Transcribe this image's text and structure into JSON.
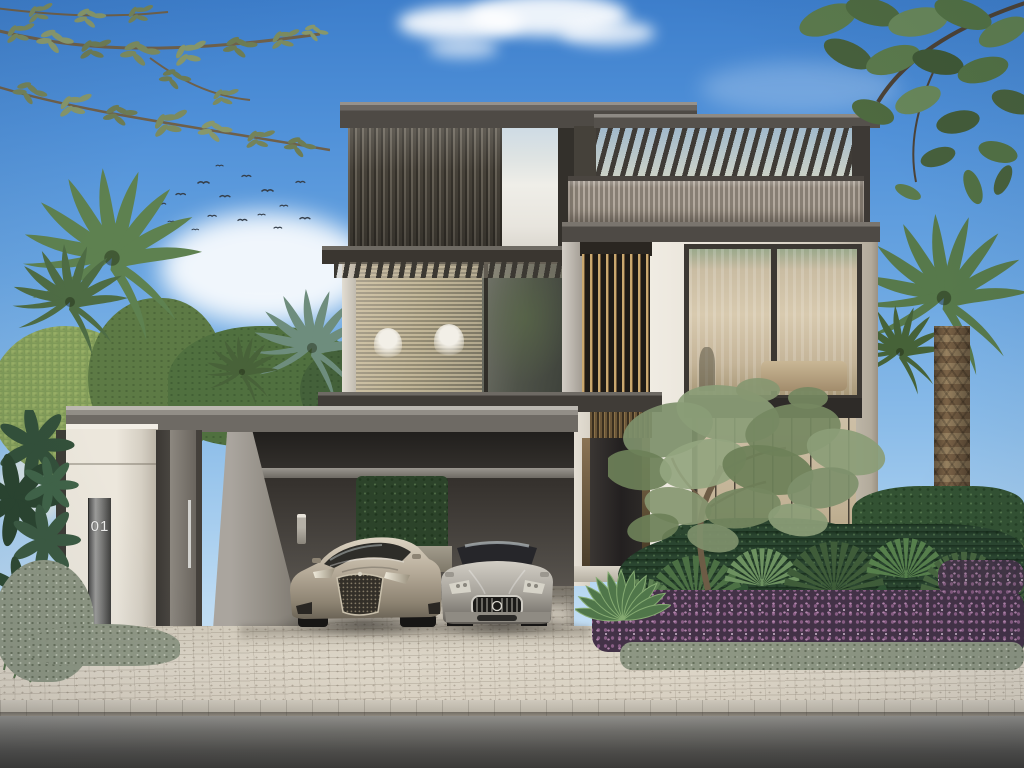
{
  "house": {
    "number_plate": {
      "value": "01",
      "material": "brushed-steel"
    }
  },
  "palette": {
    "sky_top": "#3d7ecb",
    "sky_horizon": "#d8eaf8",
    "facade_light_stone": "#eae5da",
    "facade_dark_bronze": "#4a453e",
    "louver_bronze": "#caa86f",
    "concrete_gray": "#9b968f",
    "foliage_green": "#5d7f52",
    "olive_green": "#7e906c",
    "flower_purple": "#8a5f86",
    "lawn_green": "#63824a",
    "car_left_champagne": "#b3a896",
    "car_right_silver": "#a8a49e",
    "driveway_paver": "#d9d2c4",
    "road_asphalt": "#4e4d4a"
  }
}
